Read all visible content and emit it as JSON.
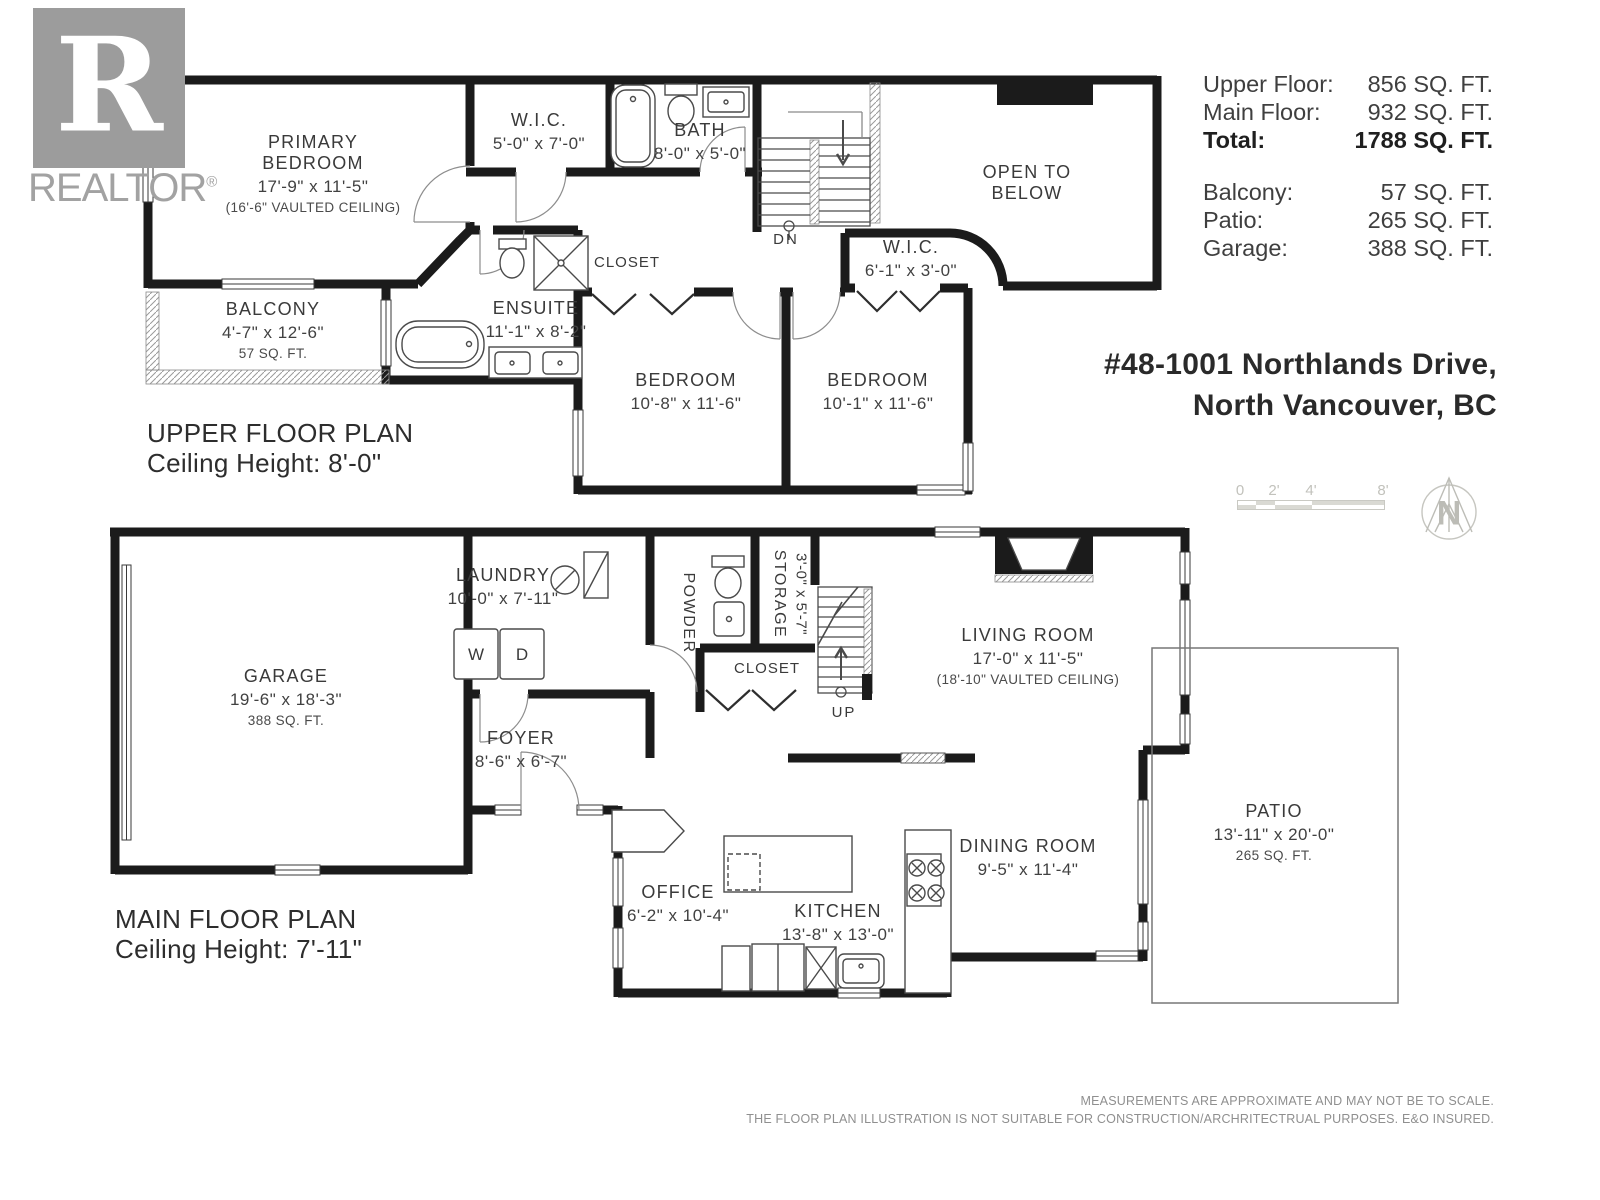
{
  "logo": {
    "word": "REALTOR",
    "reg": "®",
    "r_glyph": "R"
  },
  "summary": {
    "rows": [
      {
        "label": "Upper Floor:",
        "value": "856 SQ. FT."
      },
      {
        "label": "Main Floor:",
        "value": "932 SQ. FT."
      },
      {
        "label": "Total:",
        "value": "1788 SQ. FT."
      }
    ],
    "rows2": [
      {
        "label": "Balcony:",
        "value": "57 SQ. FT."
      },
      {
        "label": "Patio:",
        "value": "265 SQ. FT."
      },
      {
        "label": "Garage:",
        "value": "388 SQ. FT."
      }
    ]
  },
  "address": {
    "line1": "#48-1001 Northlands Drive,",
    "line2": "North Vancouver, BC"
  },
  "scale_bar": {
    "ticks": [
      "0",
      "2'",
      "4'",
      "8'"
    ]
  },
  "compass": {
    "letter": "N"
  },
  "upper_plan": {
    "title": "UPPER FLOOR PLAN",
    "ceiling": "Ceiling Height: 8'-0\"",
    "rooms": {
      "primary_bedroom": {
        "name": "PRIMARY BEDROOM",
        "dim": "17'-9\" x 11'-5\"",
        "note": "(16'-6\" VAULTED CEILING)"
      },
      "wic_left": {
        "name": "W.I.C.",
        "dim": "5'-0\" x 7'-0\""
      },
      "bath": {
        "name": "BATH",
        "dim": "8'-0\" x 5'-0\""
      },
      "open_below": {
        "name": "OPEN TO BELOW"
      },
      "stairs_dn": {
        "name": "DN"
      },
      "closet": {
        "name": "CLOSET"
      },
      "wic_right": {
        "name": "W.I.C.",
        "dim": "6'-1\" x 3'-0\""
      },
      "ensuite": {
        "name": "ENSUITE",
        "dim": "11'-1\" x 8'-2\""
      },
      "balcony": {
        "name": "BALCONY",
        "dim": "4'-7\" x 12'-6\"",
        "note": "57 SQ. FT."
      },
      "bedroom_left": {
        "name": "BEDROOM",
        "dim": "10'-8\" x 11'-6\""
      },
      "bedroom_right": {
        "name": "BEDROOM",
        "dim": "10'-1\" x 11'-6\""
      }
    }
  },
  "main_plan": {
    "title": "MAIN FLOOR PLAN",
    "ceiling": "Ceiling Height: 7'-11\"",
    "rooms": {
      "garage": {
        "name": "GARAGE",
        "dim": "19'-6\" x 18'-3\"",
        "note": "388 SQ. FT."
      },
      "laundry": {
        "name": "LAUNDRY",
        "dim": "10'-0\" x 7'-11\""
      },
      "washer": {
        "letter": "W"
      },
      "dryer": {
        "letter": "D"
      },
      "powder": {
        "name": "POWDER"
      },
      "storage": {
        "name": "STORAGE",
        "dim": "3'-0\" x 5'-7\""
      },
      "closet": {
        "name": "CLOSET"
      },
      "stairs_up": {
        "name": "UP"
      },
      "living": {
        "name": "LIVING ROOM",
        "dim": "17'-0\" x 11'-5\"",
        "note": "(18'-10\" VAULTED CEILING)"
      },
      "foyer": {
        "name": "FOYER",
        "dim": "8'-6\" x 6'-7\""
      },
      "office": {
        "name": "OFFICE",
        "dim": "6'-2\" x 10'-4\""
      },
      "kitchen": {
        "name": "KITCHEN",
        "dim": "13'-8\" x 13'-0\""
      },
      "dining": {
        "name": "DINING ROOM",
        "dim": "9'-5\" x 11'-4\""
      },
      "patio": {
        "name": "PATIO",
        "dim": "13'-11\" x 20'-0\"",
        "note": "265 SQ. FT."
      }
    }
  },
  "disclaimer": {
    "line1": "MEASUREMENTS ARE APPROXIMATE AND MAY NOT BE TO SCALE.",
    "line2": "THE FLOOR PLAN ILLUSTRATION IS NOT SUITABLE FOR CONSTRUCTION/ARCHRITECTRUAL PURPOSES. E&O INSURED."
  }
}
